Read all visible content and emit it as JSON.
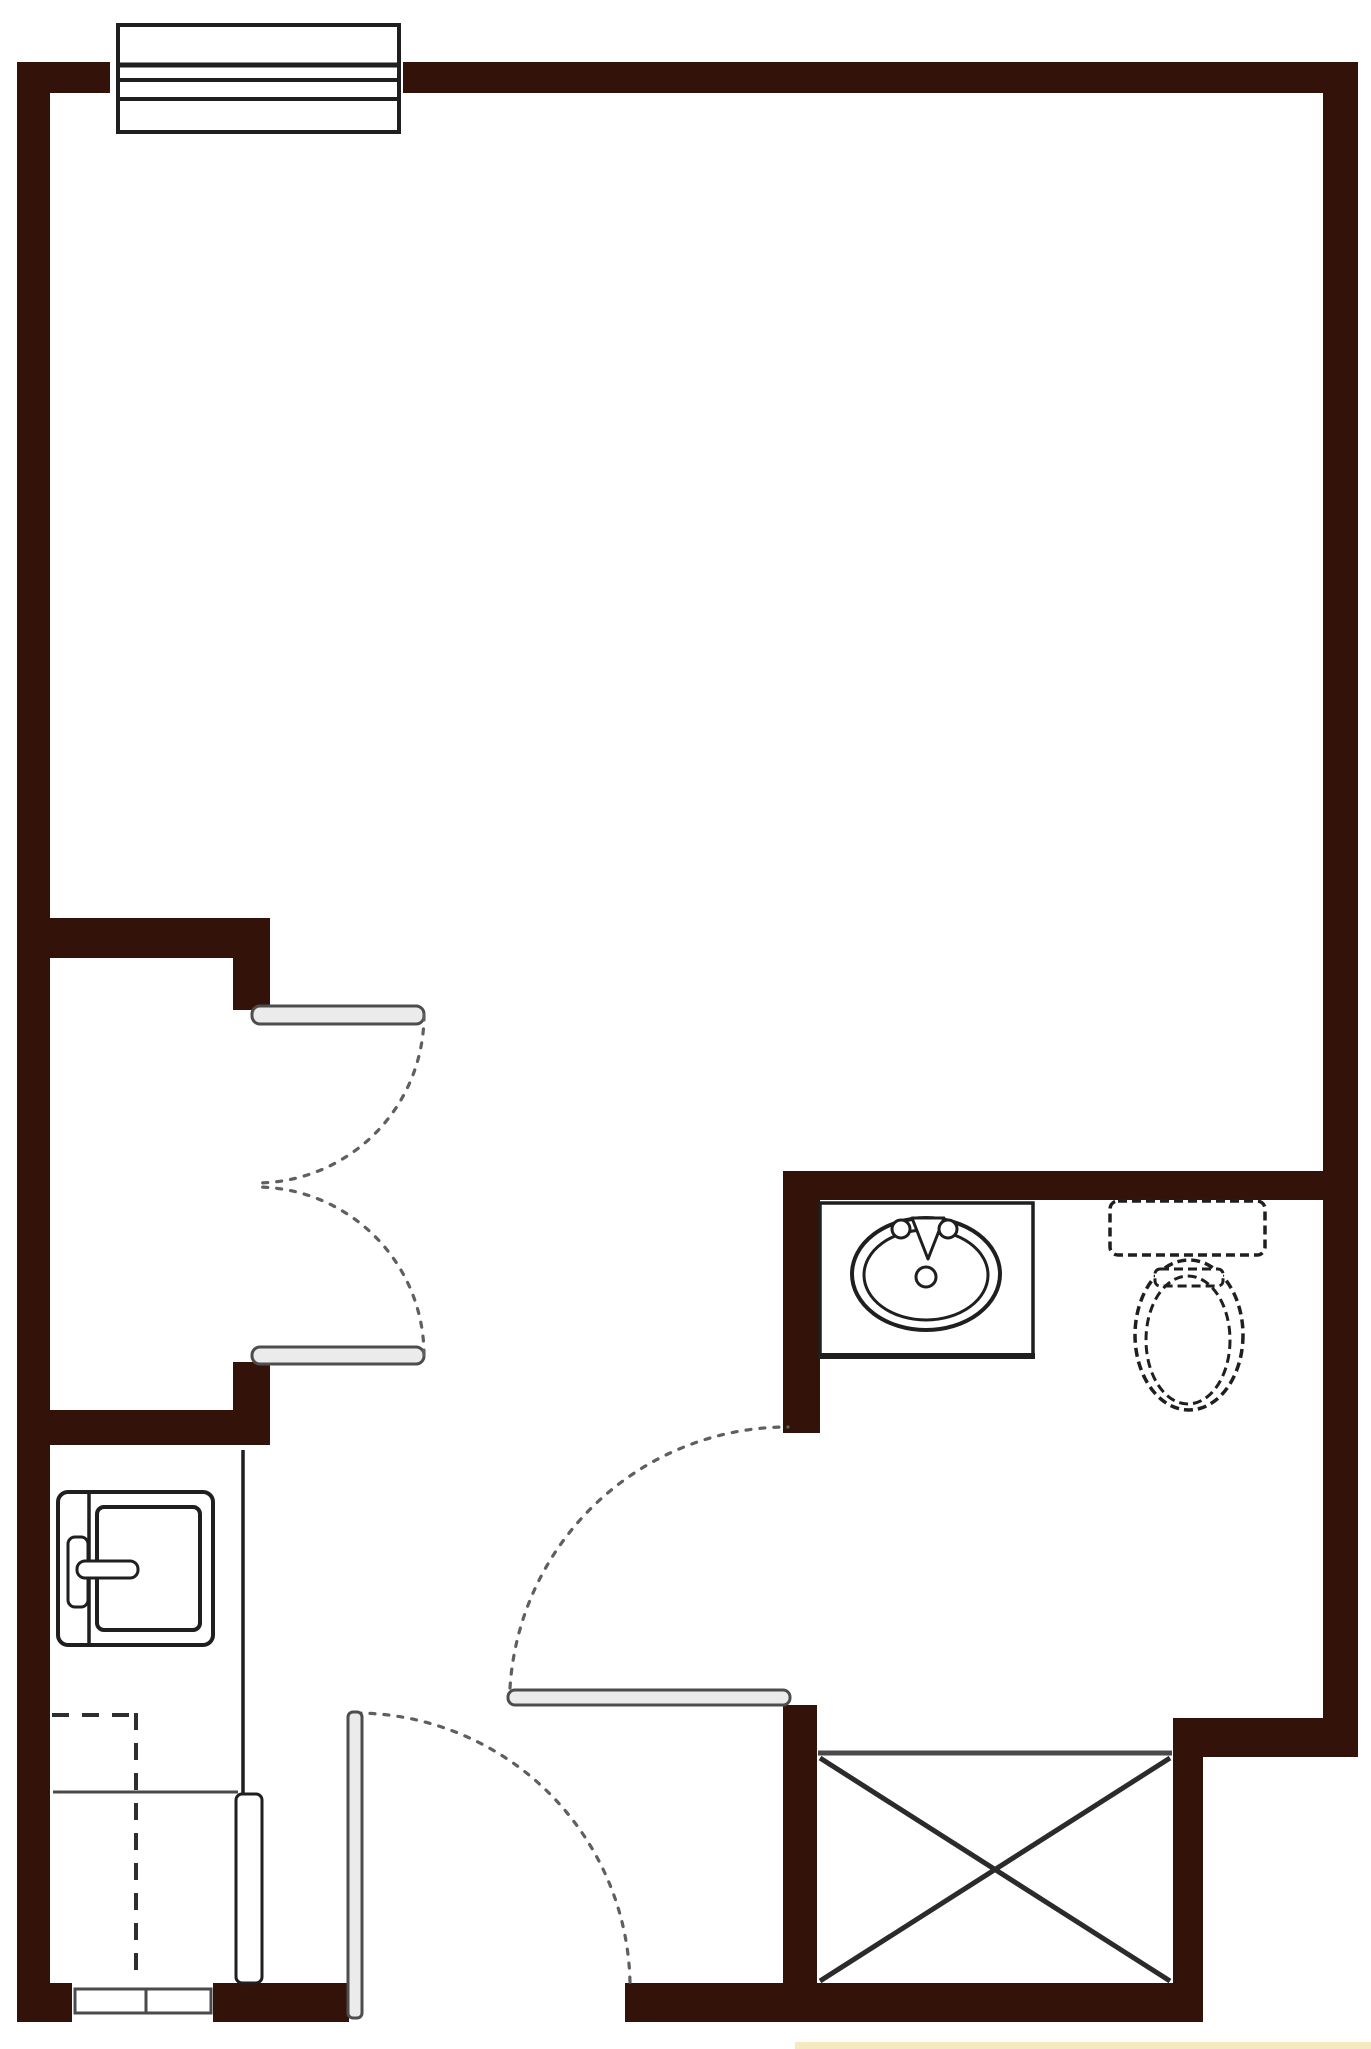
{
  "colors": {
    "wall": "#33120a",
    "line": "#1f1f1f",
    "soft": "#4a4a4a",
    "arc": "#5f5f5f",
    "leaffill": "#ebebeb",
    "leafstroke": "#4d4d4d",
    "strip": "#f5e9bf",
    "bg": "#ffffff"
  },
  "floor_plan": {
    "type": "studio-unit-floor-plan",
    "walls": "dark-brown-filled",
    "fixtures": [
      {
        "id": "window",
        "kind": "window-symbol",
        "wall": "top"
      },
      {
        "id": "closet-door-upper",
        "kind": "swing-door-leaf"
      },
      {
        "id": "closet-door-lower",
        "kind": "swing-door-leaf"
      },
      {
        "id": "kitchen-sink",
        "kind": "single-basin-sink-with-faucet"
      },
      {
        "id": "kitchen-counter",
        "kind": "counter-edge"
      },
      {
        "id": "upper-cabinet",
        "kind": "dashed-overhead-cabinet"
      },
      {
        "id": "pass-through-opening",
        "kind": "double-pane-opening",
        "wall": "bottom"
      },
      {
        "id": "entry-door",
        "kind": "swing-door-leaf-with-arc"
      },
      {
        "id": "bathroom-door",
        "kind": "swing-door-leaf-with-arc"
      },
      {
        "id": "vanity-sink",
        "kind": "oval-lavatory-on-vanity"
      },
      {
        "id": "toilet",
        "kind": "tank-and-bowl-toilet"
      },
      {
        "id": "shower-enclosure",
        "kind": "x-marked-box"
      }
    ]
  }
}
